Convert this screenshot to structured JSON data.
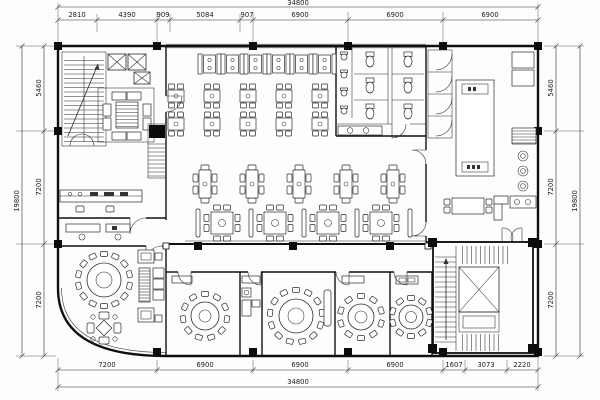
{
  "drawing": {
    "dims_top": {
      "total": "34800",
      "segments": [
        "2810",
        "4390",
        "909",
        "5084",
        "907",
        "6900",
        "6900",
        "6900"
      ]
    },
    "dims_bottom": {
      "total": "34800",
      "segments": [
        "7200",
        "6900",
        "6900",
        "6900",
        "1607",
        "3073",
        "2220"
      ]
    },
    "dims_left": {
      "total": "19800",
      "segments": [
        "5460",
        "7200",
        "7200"
      ]
    },
    "dims_right": {
      "total": "19800",
      "segments": [
        "5460",
        "7200",
        "7200"
      ]
    }
  }
}
